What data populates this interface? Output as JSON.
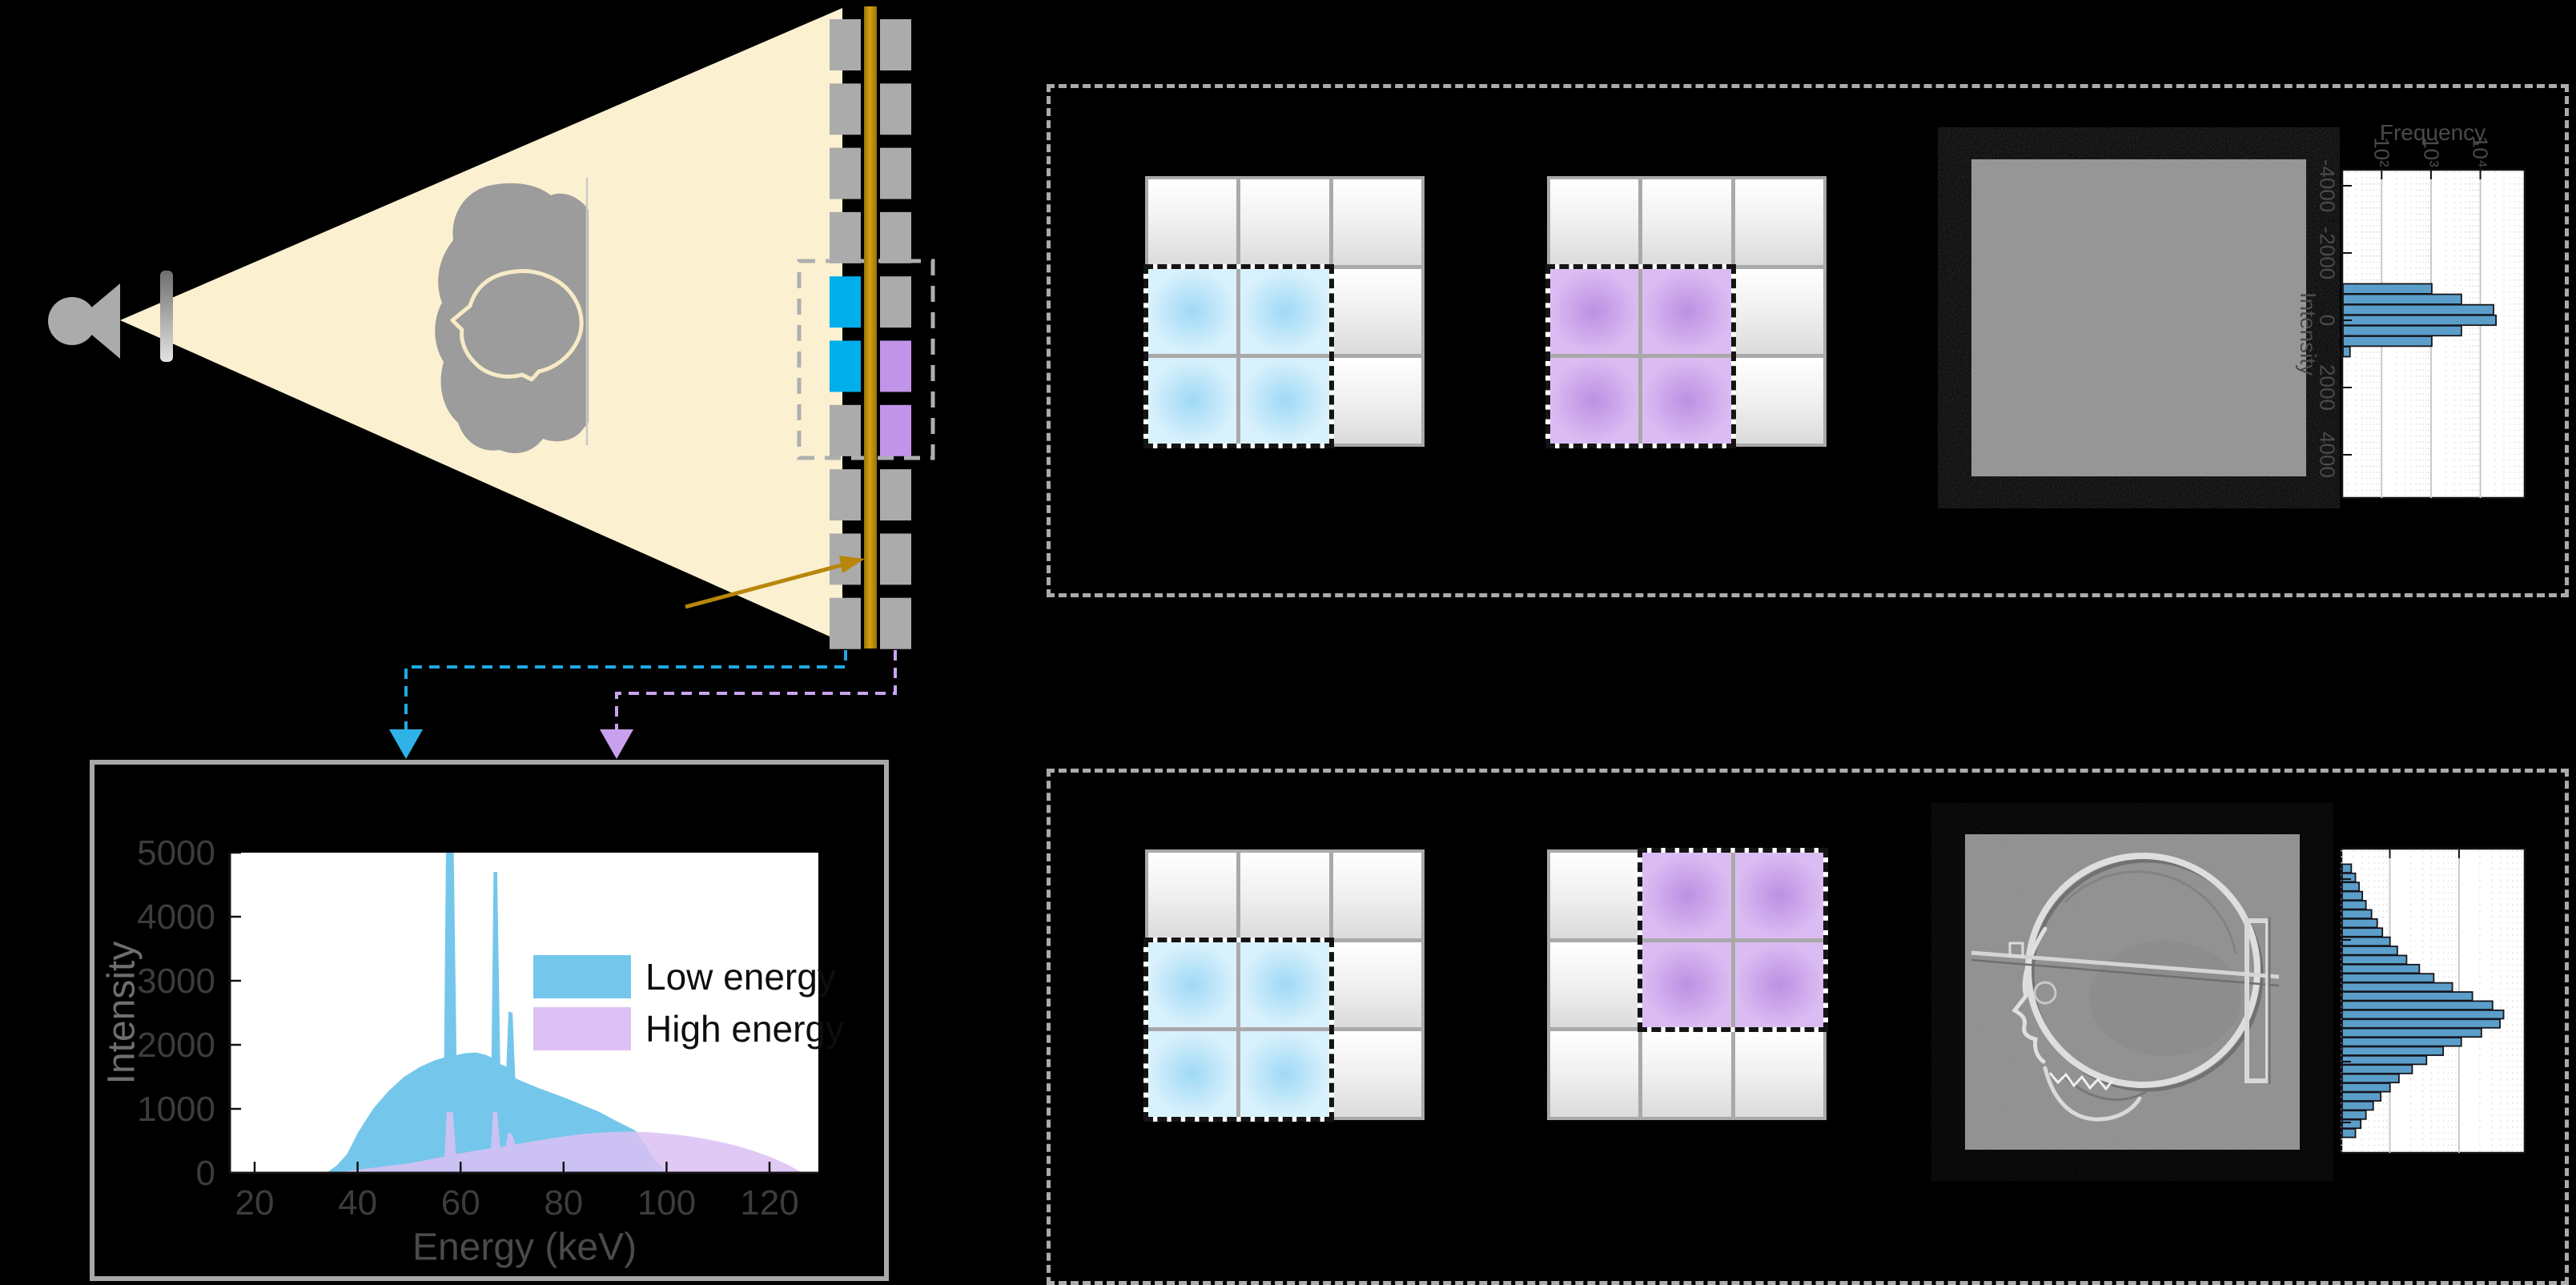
{
  "figure": {
    "background": "#000000",
    "description": "dual-energy x-ray imaging schematic"
  },
  "colors": {
    "beam": "#FBF0D0",
    "hardware_gray": "#ABABAB",
    "phantom_gray": "#9C9C9C",
    "head_outline": "#F6EBC6",
    "filter_gold": "#B8860B",
    "detector_low": "#00AEEA",
    "detector_high": "#C193E9",
    "connector_low": "#1FA9E2",
    "connector_high": "#C9A4F0",
    "spectrum_low": "#74C7EA",
    "spectrum_high": "#DCC0F4",
    "histogram_bar": "#5B9EC9",
    "grid_line": "#A9A9A9",
    "dashed_box": "#ABABAB",
    "image_gray": "#8F8F8F"
  },
  "labels": {
    "spectrum_ylabel": "Intensity",
    "spectrum_xlabel": "Energy (keV)",
    "legend_low": "Low energy",
    "legend_high": "High energy",
    "hist_freq": "Frequency",
    "hist_intensity": "Intensity"
  },
  "detector": {
    "rows": 10,
    "low_energy_rows": [
      4,
      5
    ],
    "high_energy_rows": [
      5,
      6
    ],
    "roi_rows": [
      4,
      5,
      6
    ]
  },
  "pixel_grids": [
    {
      "name": "low-energy-pixels-aligned",
      "highlight": "low",
      "cells": [
        [
          1,
          0
        ],
        [
          1,
          1
        ],
        [
          2,
          0
        ],
        [
          2,
          1
        ]
      ]
    },
    {
      "name": "high-energy-pixels-aligned",
      "highlight": "high",
      "cells": [
        [
          1,
          0
        ],
        [
          1,
          1
        ],
        [
          2,
          0
        ],
        [
          2,
          1
        ]
      ]
    },
    {
      "name": "low-energy-pixels-shifted",
      "highlight": "low",
      "cells": [
        [
          1,
          0
        ],
        [
          1,
          1
        ],
        [
          2,
          0
        ],
        [
          2,
          1
        ]
      ]
    },
    {
      "name": "high-energy-pixels-shifted",
      "highlight": "high",
      "cells": [
        [
          0,
          1
        ],
        [
          0,
          2
        ],
        [
          1,
          1
        ],
        [
          1,
          2
        ]
      ]
    }
  ],
  "chart_data": [
    {
      "id": "xray-spectra",
      "type": "area",
      "xlabel": "Energy (keV)",
      "ylabel": "Intensity",
      "xlim": [
        15,
        130
      ],
      "ylim": [
        0,
        5000
      ],
      "x_ticks": [
        20,
        40,
        60,
        80,
        100,
        120
      ],
      "y_ticks": [
        0,
        1000,
        2000,
        3000,
        4000,
        5000
      ],
      "grid": false,
      "legend_position": "upper right",
      "series": [
        {
          "name": "Low energy",
          "color": "#74C7EA",
          "opacity": 1.0,
          "points": [
            [
              34,
              0
            ],
            [
              36,
              120
            ],
            [
              38,
              300
            ],
            [
              40,
              620
            ],
            [
              43,
              1000
            ],
            [
              46,
              1280
            ],
            [
              49,
              1500
            ],
            [
              52,
              1650
            ],
            [
              55,
              1760
            ],
            [
              56.8,
              1800
            ],
            [
              57.2,
              5400
            ],
            [
              58.6,
              5400
            ],
            [
              59.2,
              1840
            ],
            [
              61,
              1870
            ],
            [
              63,
              1880
            ],
            [
              65,
              1840
            ],
            [
              66.0,
              1800
            ],
            [
              66.4,
              4700
            ],
            [
              67.1,
              4700
            ],
            [
              67.7,
              1700
            ],
            [
              68.9,
              1660
            ],
            [
              69.3,
              2520
            ],
            [
              70.1,
              2500
            ],
            [
              70.6,
              1480
            ],
            [
              72,
              1430
            ],
            [
              75,
              1330
            ],
            [
              78,
              1240
            ],
            [
              81,
              1150
            ],
            [
              84,
              1050
            ],
            [
              87,
              950
            ],
            [
              90,
              820
            ],
            [
              92,
              740
            ],
            [
              94,
              660
            ],
            [
              96,
              420
            ],
            [
              98,
              180
            ],
            [
              100,
              0
            ]
          ]
        },
        {
          "name": "High energy",
          "color": "#DCC0F4",
          "opacity": 0.85,
          "points": [
            [
              35,
              0
            ],
            [
              40,
              50
            ],
            [
              45,
              100
            ],
            [
              50,
              150
            ],
            [
              54,
              210
            ],
            [
              56.9,
              255
            ],
            [
              57.3,
              950
            ],
            [
              58.5,
              950
            ],
            [
              59.1,
              295
            ],
            [
              61,
              320
            ],
            [
              64,
              360
            ],
            [
              65.9,
              385
            ],
            [
              66.3,
              950
            ],
            [
              67.1,
              950
            ],
            [
              67.7,
              400
            ],
            [
              68.8,
              420
            ],
            [
              69.2,
              625
            ],
            [
              70.0,
              610
            ],
            [
              70.6,
              445
            ],
            [
              72,
              465
            ],
            [
              75,
              505
            ],
            [
              78,
              545
            ],
            [
              81,
              580
            ],
            [
              84,
              610
            ],
            [
              87,
              628
            ],
            [
              90,
              640
            ],
            [
              93,
              645
            ],
            [
              96,
              638
            ],
            [
              99,
              620
            ],
            [
              102,
              598
            ],
            [
              105,
              565
            ],
            [
              108,
              525
            ],
            [
              111,
              475
            ],
            [
              114,
              415
            ],
            [
              117,
              340
            ],
            [
              120,
              255
            ],
            [
              122,
              185
            ],
            [
              124,
              110
            ],
            [
              125.5,
              40
            ],
            [
              126.2,
              0
            ]
          ]
        }
      ]
    },
    {
      "id": "difference-histogram-flat",
      "type": "bar",
      "orientation": "horizontal",
      "xlabel": "Frequency",
      "ylabel": "Intensity",
      "x_scale": "log",
      "xlim_log": [
        1.2,
        4.9
      ],
      "decades": [
        2,
        3,
        4
      ],
      "x_tick_labels": [
        "10²",
        "10³",
        "10⁴"
      ],
      "y_ticks": [
        -4000,
        -2000,
        0,
        2000,
        4000
      ],
      "bar_color": "#5B9EC9",
      "bins": [
        -936,
        -624,
        -312,
        0,
        312,
        624,
        936
      ],
      "frequencies": [
        1000,
        3980,
        17800,
        20000,
        3980,
        1000,
        22
      ]
    },
    {
      "id": "difference-histogram-skull",
      "type": "bar",
      "orientation": "horizontal",
      "x_scale": "log",
      "xlim_log": [
        1.3,
        3.95
      ],
      "decades": [
        2,
        3
      ],
      "x_tick_labels": [],
      "y_ticks": [],
      "bar_color": "#5B9EC9",
      "bins": [
        -3306,
        -3078,
        -2850,
        -2622,
        -2394,
        -2166,
        -1938,
        -1710,
        -1482,
        -1254,
        -1026,
        -798,
        -570,
        -342,
        -114,
        114,
        342,
        570,
        798,
        1026,
        1254,
        1482,
        1710,
        1938,
        2166,
        2394,
        2622,
        2850,
        3078,
        3306
      ],
      "frequencies": [
        27,
        31,
        35,
        39,
        44,
        53,
        64,
        76,
        98,
        125,
        170,
        260,
        420,
        780,
        1520,
        2970,
        4290,
        3810,
        2050,
        1050,
        575,
        330,
        205,
        132,
        98,
        72,
        56,
        44,
        37,
        31
      ]
    }
  ]
}
